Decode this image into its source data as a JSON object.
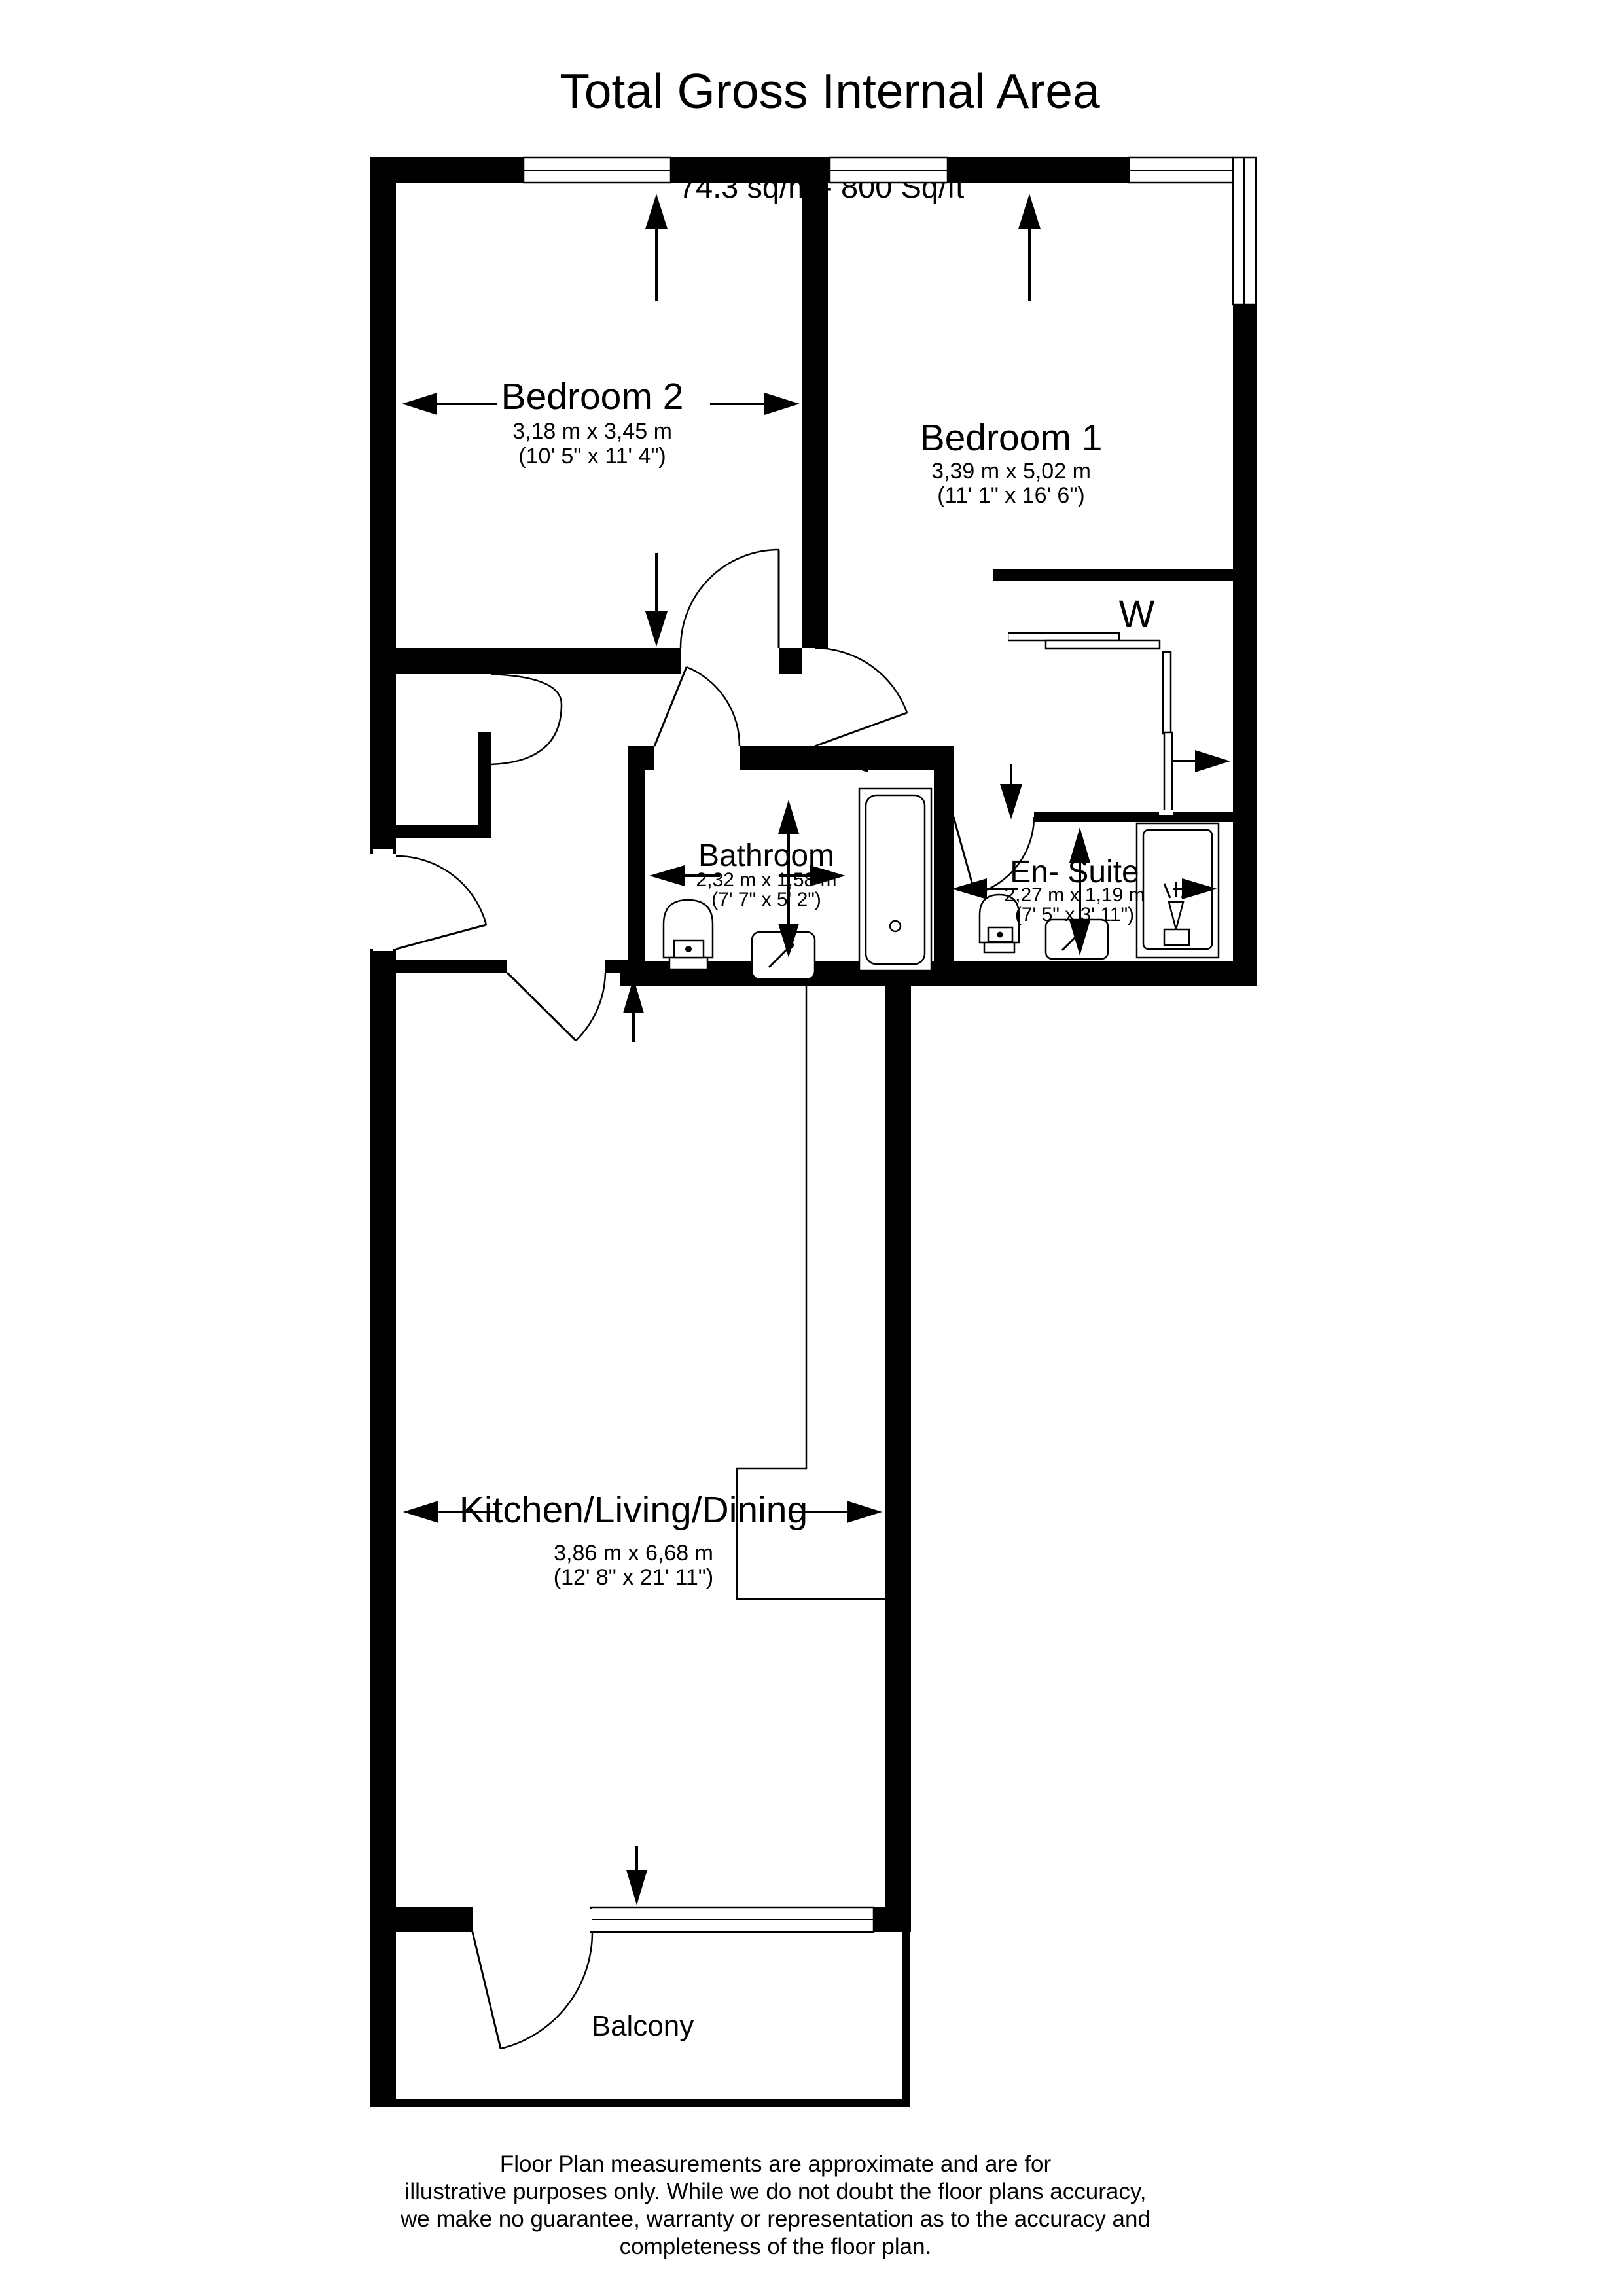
{
  "header": {
    "title": "Total Gross Internal Area",
    "subtitle": "74.3 sq/m - 800 Sq/ft"
  },
  "rooms": {
    "bedroom2": {
      "name": "Bedroom 2",
      "metric": "3,18 m x 3,45 m",
      "imperial": "(10' 5\" x 11' 4\")"
    },
    "bedroom1": {
      "name": "Bedroom 1",
      "metric": "3,39 m x 5,02 m",
      "imperial": "(11' 1\" x 16' 6\")"
    },
    "bathroom": {
      "name": "Bathroom",
      "metric": "2,32 m x 1,58 m",
      "imperial": "(7' 7\" x 5' 2\")"
    },
    "ensuite": {
      "name": "En- Suite",
      "metric": "2,27 m x 1,19 m",
      "imperial": "(7' 5\" x 3' 11\")"
    },
    "kitchen": {
      "name": "Kitchen/Living/Dining",
      "metric": "3,86 m x 6,68 m",
      "imperial": "(12' 8\" x 21' 11\")"
    },
    "balcony": {
      "name": "Balcony"
    },
    "wardrobe": {
      "label": "W"
    }
  },
  "footer": {
    "line1": "Floor Plan measurements are approximate and are for",
    "line2": "illustrative purposes only.  While we do not doubt the floor plans accuracy,",
    "line3": "we make no guarantee, warranty or representation as to the accuracy and",
    "line4": "completeness of the floor plan."
  },
  "colors": {
    "wall": "#000000",
    "background": "#ffffff"
  }
}
